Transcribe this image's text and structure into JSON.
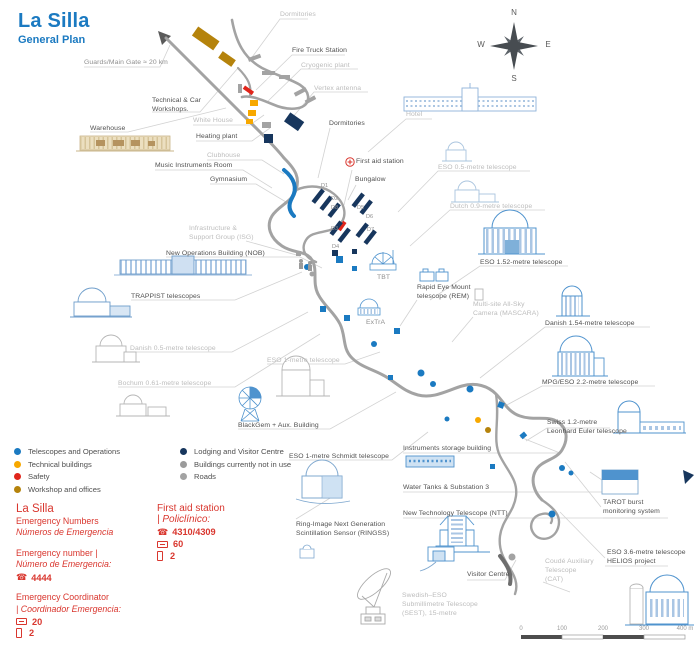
{
  "title": {
    "main": "La Silla",
    "subtitle": "General Plan"
  },
  "compass": {
    "north": "N",
    "east": "E",
    "south": "S",
    "west": "W"
  },
  "colors": {
    "accent_blue": "#1b7ac1",
    "telescopes": "#1b7ac1",
    "technical": "#f7a800",
    "safety": "#e0251b",
    "workshop": "#b5830c",
    "lodging": "#17365d",
    "not_in_use": "#9b9b9b",
    "roads": "#a3a3a3",
    "emergency_red": "#d9362e"
  },
  "map_labels": [
    {
      "id": "guards-main-gate",
      "lines": [
        "Guards/Main Gate ≈ 20 km"
      ],
      "x": 84,
      "y": 59,
      "tone": "mid"
    },
    {
      "id": "dormitories-top",
      "lines": [
        "Dormitories"
      ],
      "x": 280,
      "y": 11,
      "tone": "light"
    },
    {
      "id": "fire-truck-station",
      "lines": [
        "Fire Truck Station"
      ],
      "x": 292,
      "y": 47,
      "tone": "dark"
    },
    {
      "id": "cryogenic-plant",
      "lines": [
        "Cryogenic plant"
      ],
      "x": 301,
      "y": 62,
      "tone": "light"
    },
    {
      "id": "vertex-antenna",
      "lines": [
        "Vertex antenna"
      ],
      "x": 314,
      "y": 85,
      "tone": "light"
    },
    {
      "id": "technical-car-workshops",
      "lines": [
        "Technical & Car",
        "Workshops."
      ],
      "x": 152,
      "y": 97,
      "tone": "dark"
    },
    {
      "id": "warehouse",
      "lines": [
        "Warehouse"
      ],
      "x": 90,
      "y": 125,
      "tone": "dark"
    },
    {
      "id": "white-house",
      "lines": [
        "White House"
      ],
      "x": 193,
      "y": 117,
      "tone": "light"
    },
    {
      "id": "heating-plant",
      "lines": [
        "Heating plant"
      ],
      "x": 196,
      "y": 133,
      "tone": "dark"
    },
    {
      "id": "clubhouse",
      "lines": [
        "Clubhouse"
      ],
      "x": 207,
      "y": 152,
      "tone": "light"
    },
    {
      "id": "music-instruments-room",
      "lines": [
        "Music Instruments Room"
      ],
      "x": 155,
      "y": 162,
      "tone": "dark"
    },
    {
      "id": "gymnasium",
      "lines": [
        "Gymnasium"
      ],
      "x": 210,
      "y": 176,
      "tone": "dark"
    },
    {
      "id": "hotel",
      "lines": [
        "Hotel"
      ],
      "x": 406,
      "y": 111,
      "tone": "light"
    },
    {
      "id": "dormitories-main",
      "lines": [
        "Dormitories"
      ],
      "x": 329,
      "y": 120,
      "tone": "dark"
    },
    {
      "id": "first-aid-station-map",
      "lines": [
        "First aid station"
      ],
      "x": 356,
      "y": 158,
      "tone": "dark"
    },
    {
      "id": "bungalow",
      "lines": [
        "Bungalow"
      ],
      "x": 355,
      "y": 176,
      "tone": "dark"
    },
    {
      "id": "eso-05-telescope",
      "lines": [
        "ESO 0.5-metre telescope"
      ],
      "x": 438,
      "y": 164,
      "tone": "light"
    },
    {
      "id": "dutch-09-telescope",
      "lines": [
        "Dutch 0.9-metre telescope"
      ],
      "x": 450,
      "y": 203,
      "tone": "light"
    },
    {
      "id": "eso-152-telescope",
      "lines": [
        "ESO 1.52-metre telescope"
      ],
      "x": 480,
      "y": 259,
      "tone": "dark"
    },
    {
      "id": "rem-telescope",
      "lines": [
        "Rapid Eye Mount",
        "telescope (REM)"
      ],
      "x": 417,
      "y": 284,
      "tone": "dark"
    },
    {
      "id": "mascara-camera",
      "lines": [
        "Multi-site All-Sky",
        "Camera (MASCARA)"
      ],
      "x": 473,
      "y": 301,
      "tone": "light"
    },
    {
      "id": "danish-154-telescope",
      "lines": [
        "Danish 1.54-metre telescope"
      ],
      "x": 545,
      "y": 320,
      "tone": "dark"
    },
    {
      "id": "mpg-22-telescope",
      "lines": [
        "MPG/ESO 2.2-metre telescope"
      ],
      "x": 542,
      "y": 379,
      "tone": "dark"
    },
    {
      "id": "isg",
      "lines": [
        "Infrastructure &",
        "Support Group (ISG)"
      ],
      "x": 189,
      "y": 225,
      "tone": "light"
    },
    {
      "id": "nob",
      "lines": [
        "New Operations Building (NOB)"
      ],
      "x": 166,
      "y": 250,
      "tone": "dark"
    },
    {
      "id": "trappist-telescopes",
      "lines": [
        "TRAPPIST telescopes"
      ],
      "x": 131,
      "y": 293,
      "tone": "dark"
    },
    {
      "id": "danish-05-telescope",
      "lines": [
        "Danish 0.5-metre telescope"
      ],
      "x": 130,
      "y": 345,
      "tone": "light"
    },
    {
      "id": "bochum-telescope",
      "lines": [
        "Bochum 0.61-metre telescope"
      ],
      "x": 118,
      "y": 380,
      "tone": "light"
    },
    {
      "id": "eso-1m-telescope",
      "lines": [
        "ESO 1-metre telescope"
      ],
      "x": 267,
      "y": 357,
      "tone": "light"
    },
    {
      "id": "blackgem",
      "lines": [
        "BlackGem + Aux. Building"
      ],
      "x": 238,
      "y": 422,
      "tone": "dark"
    },
    {
      "id": "swiss-euler-telescope",
      "lines": [
        "Swiss 1.2-metre",
        "Leonhard Euler telescope"
      ],
      "x": 547,
      "y": 419,
      "tone": "dark"
    },
    {
      "id": "eso-schmidt-telescope",
      "lines": [
        "ESO 1-metre Schmidt telescope"
      ],
      "x": 289,
      "y": 453,
      "tone": "dark"
    },
    {
      "id": "instruments-storage",
      "lines": [
        "Instruments storage building"
      ],
      "x": 403,
      "y": 445,
      "tone": "dark"
    },
    {
      "id": "water-tanks",
      "lines": [
        "Water Tanks & Substation 3"
      ],
      "x": 403,
      "y": 484,
      "tone": "dark"
    },
    {
      "id": "ntt",
      "lines": [
        "New Technology Telescope (NTT)"
      ],
      "x": 403,
      "y": 510,
      "tone": "dark"
    },
    {
      "id": "ringss",
      "lines": [
        "Ring-Image Next Generation",
        "Scintillation Sensor (RINGSS)"
      ],
      "x": 296,
      "y": 521,
      "tone": "dark"
    },
    {
      "id": "tarot",
      "lines": [
        "TAROT burst",
        "monitoring system"
      ],
      "x": 603,
      "y": 499,
      "tone": "dark"
    },
    {
      "id": "eso-36-telescope",
      "lines": [
        "ESO 3.6-metre telescope",
        "HELIOS project"
      ],
      "x": 607,
      "y": 549,
      "tone": "dark"
    },
    {
      "id": "cat",
      "lines": [
        "Coudé Auxiliary",
        "Telescope",
        "(CAT)"
      ],
      "x": 545,
      "y": 558,
      "tone": "light"
    },
    {
      "id": "visitor-centre",
      "lines": [
        "Visitor Centre"
      ],
      "x": 467,
      "y": 571,
      "tone": "dark"
    },
    {
      "id": "sest",
      "lines": [
        "Swedish–ESO",
        "Submillimetre Telescope",
        "(SEST), 15-metre"
      ],
      "x": 402,
      "y": 592,
      "tone": "light"
    },
    {
      "id": "tbt",
      "lines": [
        "TBT"
      ],
      "x": 377,
      "y": 274,
      "tone": "mid"
    },
    {
      "id": "extra",
      "lines": [
        "ExTrA"
      ],
      "x": 366,
      "y": 319,
      "tone": "mid"
    }
  ],
  "dorm_labels": [
    {
      "text": "D1",
      "x": 321,
      "y": 183
    },
    {
      "text": "D2",
      "x": 331,
      "y": 196
    },
    {
      "text": "D8",
      "x": 331,
      "y": 205
    },
    {
      "text": "D5",
      "x": 357,
      "y": 205
    },
    {
      "text": "D6",
      "x": 366,
      "y": 214
    },
    {
      "text": "D3",
      "x": 331,
      "y": 226
    },
    {
      "text": "D7",
      "x": 367,
      "y": 227
    },
    {
      "text": "D4",
      "x": 332,
      "y": 244
    }
  ],
  "legend": {
    "items_left": [
      {
        "label": "Telescopes and Operations",
        "color": "#1b7ac1"
      },
      {
        "label": "Technical buildings",
        "color": "#f7a800"
      },
      {
        "label": "Safety",
        "color": "#e0251b"
      },
      {
        "label": "Workshop and offices",
        "color": "#b5830c"
      }
    ],
    "items_right": [
      {
        "label": "Lodging and Visitor Centre",
        "color": "#17365d"
      },
      {
        "label": "Buildings currently not in use",
        "color": "#9b9b9b"
      },
      {
        "label": "Roads",
        "color": "#a3a3a3"
      }
    ]
  },
  "emergency": {
    "heading": "La Silla",
    "subheading_en": "Emergency Numbers",
    "subheading_es": "Números de Emergencia",
    "number_label_en": "Emergency number |",
    "number_label_es": "Número de Emergencia:",
    "number": "4444",
    "coordinator_label_en": "Emergency Coordinator",
    "coordinator_label_es": "| Coordinador Emergencia:",
    "coordinator_radio": "20",
    "coordinator_phone": "2"
  },
  "first_aid": {
    "heading": "First aid station",
    "heading_es": "| Policlínico:",
    "phone": "4310/4309",
    "radio": "60",
    "mobile": "2"
  },
  "scale_bar": {
    "ticks": [
      "0",
      "100",
      "200",
      "300",
      "400 m"
    ]
  }
}
